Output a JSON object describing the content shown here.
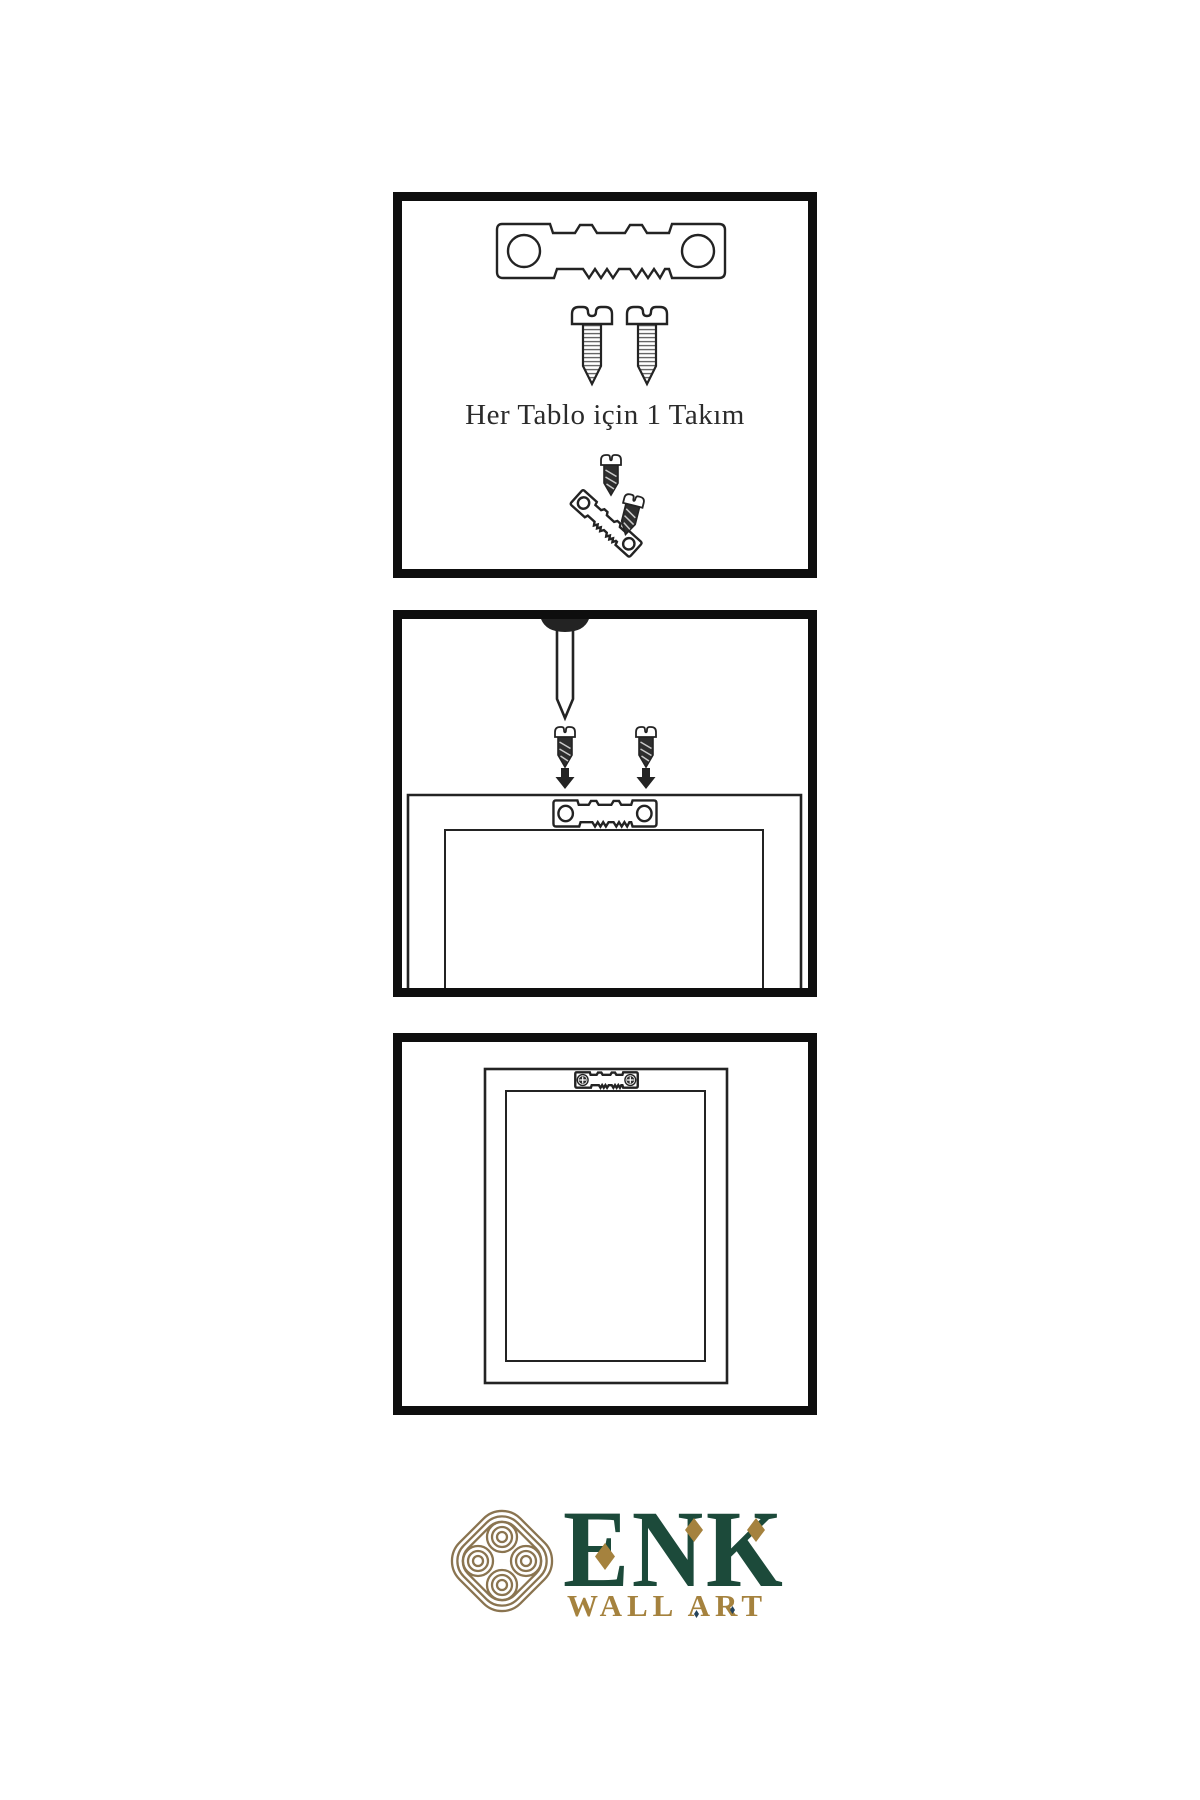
{
  "colors": {
    "ink": "#232323",
    "panel_border": "#0e0e0e",
    "metal_dark": "#2e2e2e",
    "knot_gold": "#8a7450",
    "accent_gold": "#a5823e",
    "brand_green": "#1c4a3a",
    "dot_navy": "#24435c",
    "background": "#ffffff"
  },
  "panels": [
    {
      "name": "hardware-kit",
      "caption": "Her Tablo için 1 Takım",
      "illustrations": [
        "sawtooth-hanger",
        "screw",
        "screw",
        "screw-driving-into-tilted-hanger",
        "tilted-screw"
      ]
    },
    {
      "name": "mount-hanger-on-frame-back",
      "caption": "",
      "illustrations": [
        "wall-nail",
        "screw-with-down-arrow",
        "screw-with-down-arrow",
        "frame-back-with-sawtooth-hanger"
      ]
    },
    {
      "name": "hang-frame-on-wall",
      "caption": "",
      "illustrations": [
        "framed-picture-with-mounted-sawtooth-hanger"
      ]
    }
  ],
  "logo": {
    "brand": "ENK",
    "subtitle": "WALL ART"
  }
}
